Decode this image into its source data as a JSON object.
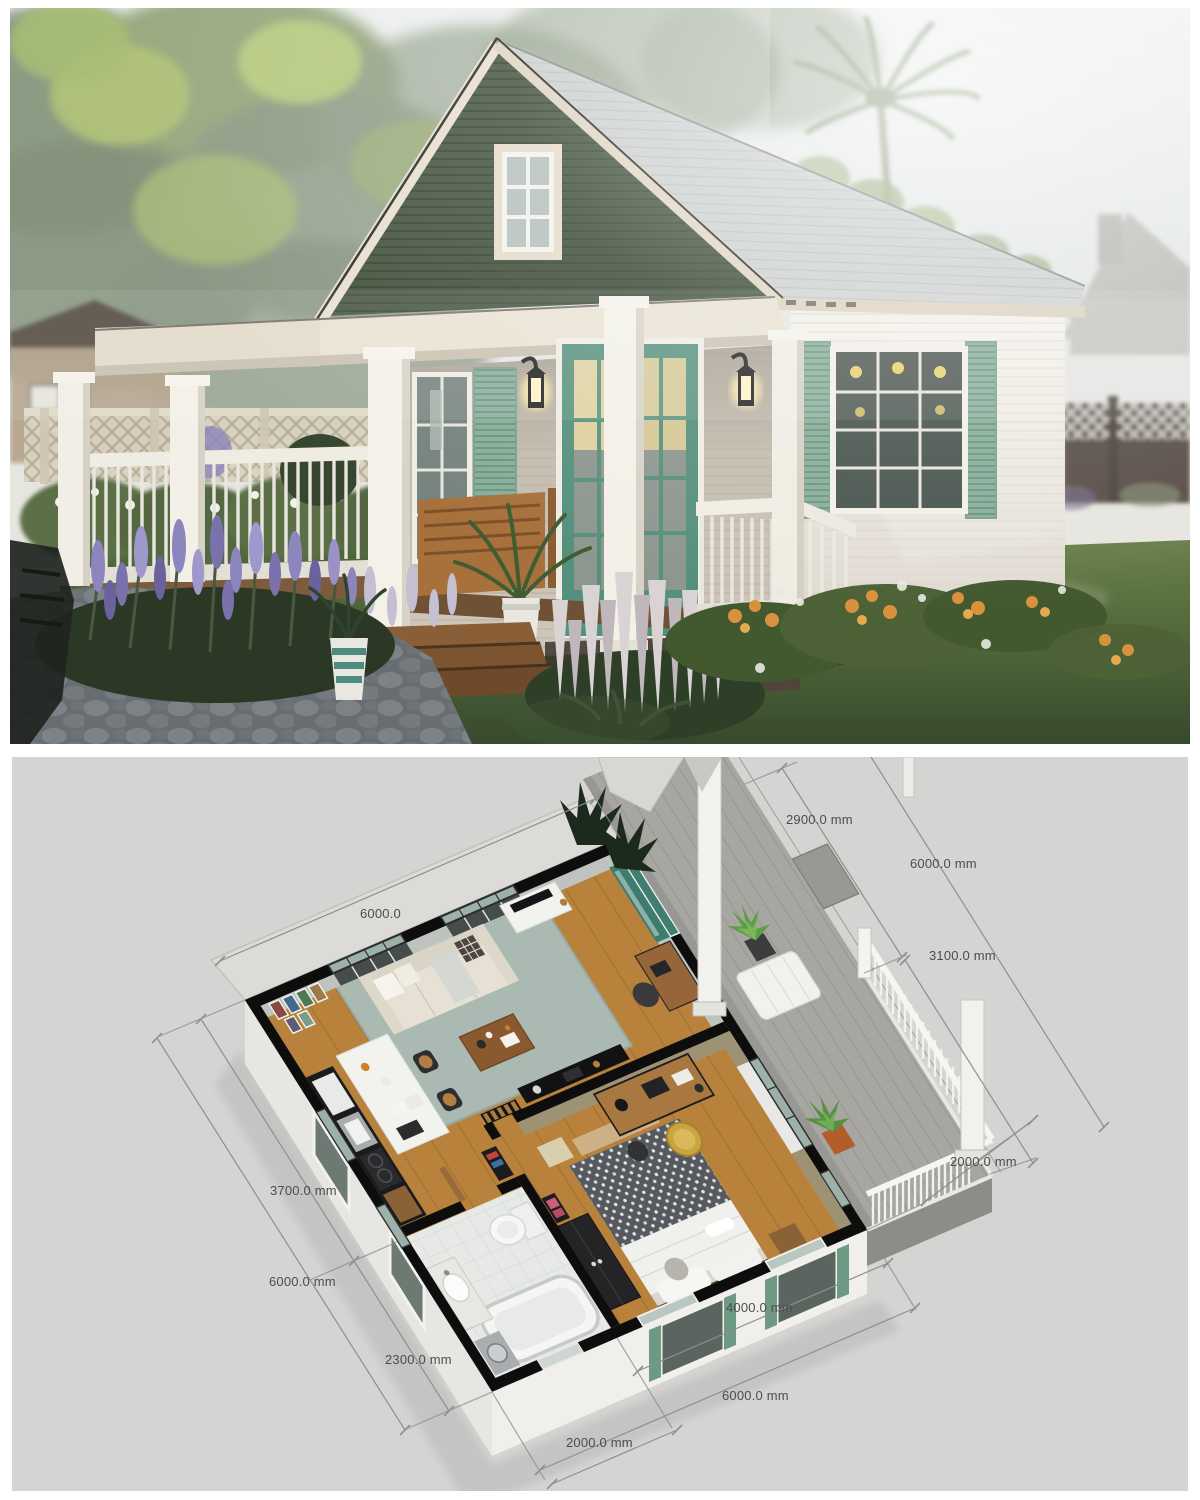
{
  "document": {
    "type": "architectural-visualization",
    "top_panel": "exterior-render-of-cottage",
    "bottom_panel": "isometric-floor-plan"
  },
  "plan": {
    "unit": "mm",
    "dimensions": [
      {
        "id": "deck-stair-opening",
        "label": "2900.0 mm"
      },
      {
        "id": "northeast-side-total",
        "label": "6000.0 mm"
      },
      {
        "id": "deck-railing-run",
        "label": "3100.0 mm"
      },
      {
        "id": "northwest-side-total",
        "label": "6000.0"
      },
      {
        "id": "deck-depth",
        "label": "2000.0 mm"
      },
      {
        "id": "living-zone-depth",
        "label": "3700.0 mm"
      },
      {
        "id": "southwest-side-total",
        "label": "6000.0 mm"
      },
      {
        "id": "bathroom-zone-depth",
        "label": "2300.0 mm"
      },
      {
        "id": "bedroom-frontage",
        "label": "4000.0 mm"
      },
      {
        "id": "southeast-side-total",
        "label": "6000.0 mm"
      },
      {
        "id": "bathroom-frontage",
        "label": "2000.0 mm"
      }
    ]
  },
  "colors": {
    "door_teal": "#4f8f7c",
    "shutter_sage": "#86ad99",
    "gable_green": "#45543f",
    "roof_gray": "#ccd0cf",
    "trim_cream": "#e7dfd0",
    "lawn_green": "#55703f",
    "lavender": "#8d85bd",
    "plan_background": "#d5d4d2",
    "wall_cut_black": "#0d0d0d",
    "floor_wood": "#b8823c",
    "rug_sage": "#aab9b2",
    "deck_gray": "#a7a6a1",
    "dimension_text": "#4d4d4d"
  }
}
